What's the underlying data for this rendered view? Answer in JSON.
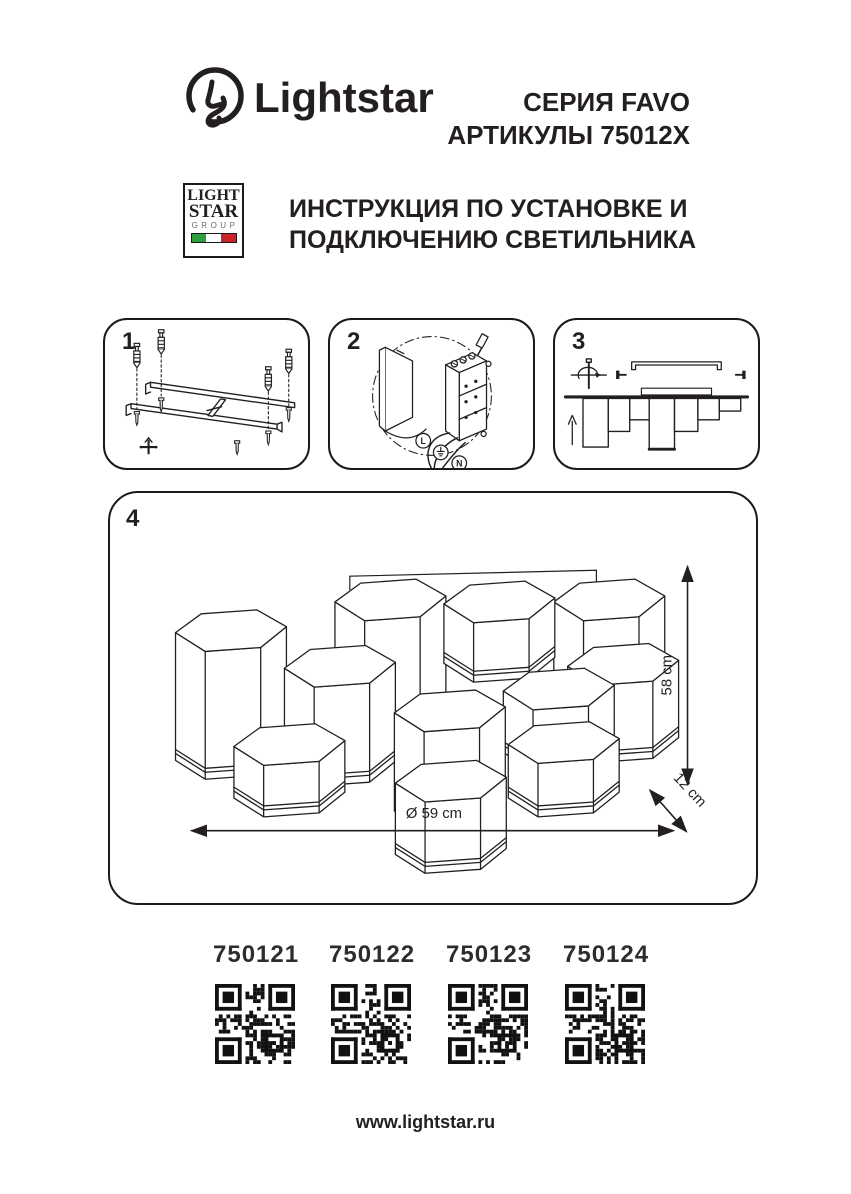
{
  "page": {
    "background": "#ffffff",
    "ink": "#231f20"
  },
  "header": {
    "brand_wordmark": "Lightstar",
    "series_line1": "СЕРИЯ FAVO",
    "series_line2": "АРТИКУЛЫ 75012X"
  },
  "group_logo": {
    "line1": "LIGHT",
    "line2": "STAR",
    "line3": "GROUP",
    "flag_green": "#2f9e3f",
    "flag_white": "#ffffff",
    "flag_red": "#cc2229"
  },
  "title": {
    "line1": "ИНСТРУКЦИЯ ПО УСТАНОВКЕ И",
    "line2": "ПОДКЛЮЧЕНИЮ СВЕТИЛЬНИКА"
  },
  "steps": [
    {
      "number": "1"
    },
    {
      "number": "2",
      "wire_label_l": "L",
      "wire_label_n": "N"
    },
    {
      "number": "3"
    }
  ],
  "diagram": {
    "number": "4",
    "height_label": "58 cm",
    "depth_label": "12 cm",
    "diameter_label": "Ø 59 cm"
  },
  "articles": [
    {
      "code": "750121"
    },
    {
      "code": "750122"
    },
    {
      "code": "750123"
    },
    {
      "code": "750124"
    }
  ],
  "footer": {
    "url": "www.lightstar.ru"
  }
}
